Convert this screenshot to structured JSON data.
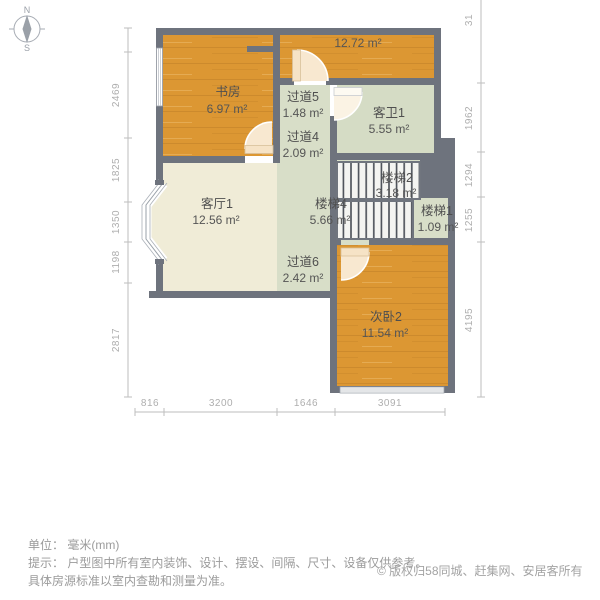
{
  "compass": {
    "north": "N",
    "south": "S"
  },
  "plan": {
    "rooms": {
      "study": {
        "name": "书房",
        "area": "6.97 m²"
      },
      "top_room": {
        "name": "",
        "area": "12.72 m²"
      },
      "hallway5": {
        "name": "过道5",
        "area": "1.48 m²"
      },
      "hallway4": {
        "name": "过道4",
        "area": "2.09 m²"
      },
      "bathroom": {
        "name": "客卫1",
        "area": "5.55 m²"
      },
      "living": {
        "name": "客厅1",
        "area": "12.56 m²"
      },
      "stairs2": {
        "name": "楼梯2",
        "area": "3.18 m²"
      },
      "stairs4": {
        "name": "楼梯4",
        "area": "5.66 m²"
      },
      "stairs1": {
        "name": "楼梯1",
        "area": "1.09 m²"
      },
      "hallway6": {
        "name": "过道6",
        "area": "2.42 m²"
      },
      "bedroom2": {
        "name": "次卧2",
        "area": "11.54 m²"
      }
    },
    "dimensions": {
      "left": [
        "2469",
        "1825",
        "1350",
        "1198",
        "2817"
      ],
      "right": [
        "31",
        "1962",
        "1294",
        "1255",
        "4195"
      ],
      "bottom": [
        "816",
        "3200",
        "1646",
        "3091"
      ]
    },
    "colors": {
      "wall": "#6e737d",
      "wood_floor": "#dc9733",
      "living_floor": "#f0ecd7",
      "corridor_floor": "#d8dec8",
      "stair_fill": "#f4f4f1",
      "door": "#f8e8d0",
      "dimension": "#aeaeae"
    }
  },
  "footer": {
    "unit_line": "单位： 毫米(mm)",
    "tip_line1": "提示： 户型图中所有室内装饰、设计、摆设、间隔、尺寸、设备仅供参考。",
    "tip_line2": "具体房源标准以室内查勘和测量为准。",
    "copyright": "© 版权归58同城、赶集网、安居客所有"
  }
}
